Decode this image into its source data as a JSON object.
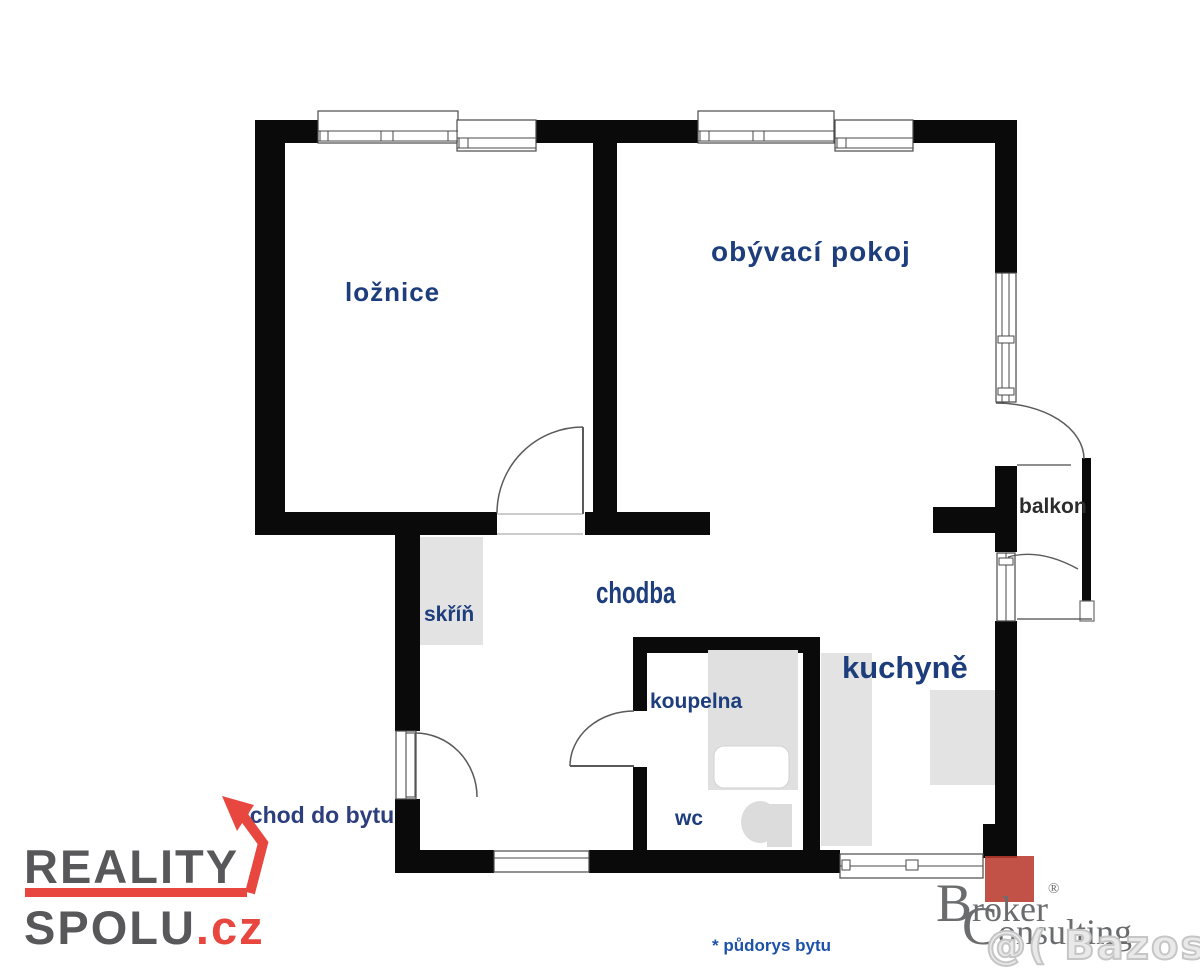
{
  "page": {
    "background": "#ffffff",
    "width": 1200,
    "height": 973
  },
  "floorplan": {
    "caption": "* půdorys bytu",
    "entrance_label": "vchod do bytu",
    "rooms": [
      {
        "id": "loznice",
        "label": "ložnice"
      },
      {
        "id": "obyvaci-pokoj",
        "label": "obývací pokoj"
      },
      {
        "id": "chodba",
        "label": "chodba"
      },
      {
        "id": "skrin",
        "label": "skříň"
      },
      {
        "id": "koupelna",
        "label": "koupelna"
      },
      {
        "id": "wc",
        "label": "wc"
      },
      {
        "id": "kuchyne",
        "label": "kuchyně"
      },
      {
        "id": "balkon",
        "label": "balkon"
      }
    ],
    "fixtures": [
      "wardrobe",
      "bathtub",
      "toilet",
      "kitchen-counter",
      "kitchen-appliance",
      "balcony-railing"
    ],
    "colors": {
      "wall": "#0a0a0a",
      "room_label": "#1d3d7c",
      "balkon_label": "#2c2c2c",
      "entrance_label": "#2c3e7e",
      "caption": "#1c52a8",
      "fixture_fill": "#e3e3e3",
      "door_line": "#5a5a5a"
    }
  },
  "branding": {
    "reality_spolu": {
      "word1": "REALITY",
      "word2": "SPOLU",
      "suffix": ".cz",
      "text_color": "#58585a",
      "accent_color": "#e8473f"
    },
    "broker_consulting": {
      "word1": "Broker",
      "word2": "Consulting",
      "registered_mark": "®",
      "text_color": "#6b6c6e",
      "square_color": "#ba3a2e"
    },
    "watermark": {
      "text": "@( Bazos.cz"
    }
  }
}
